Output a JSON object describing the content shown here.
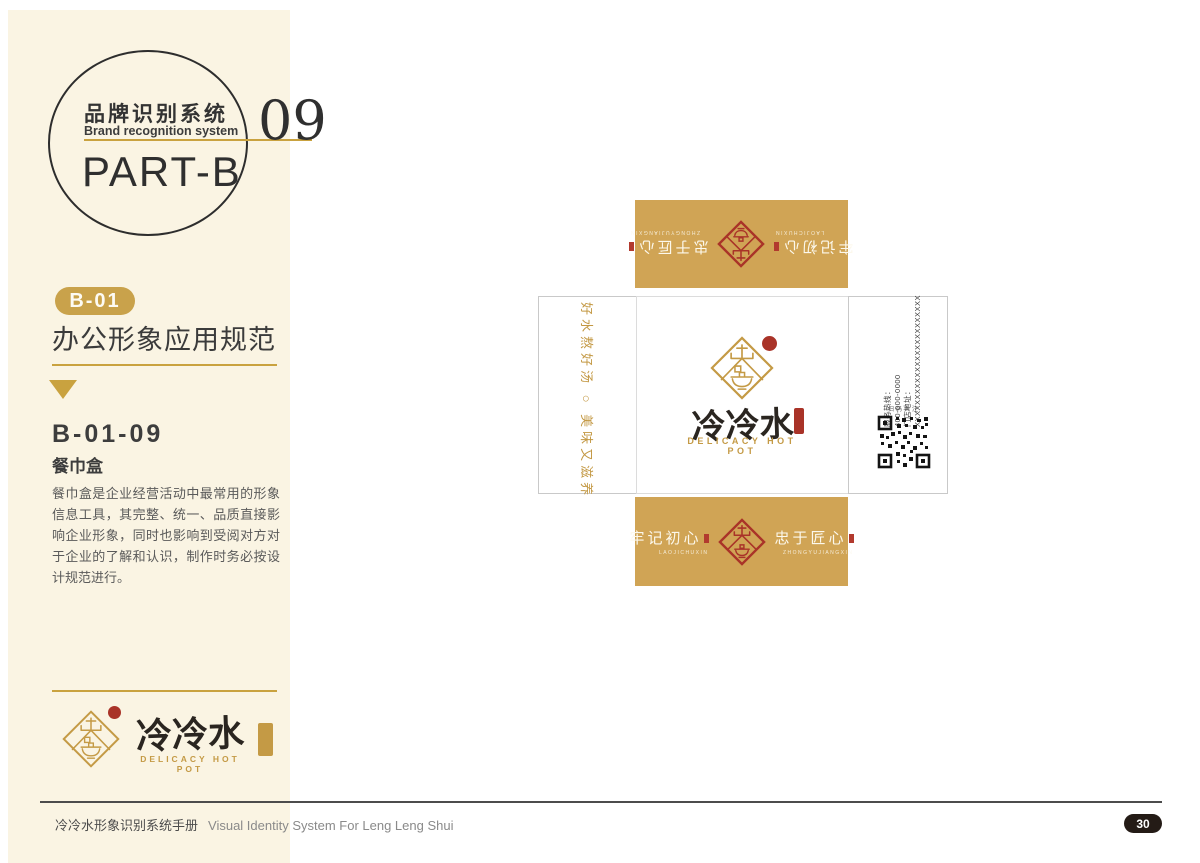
{
  "header": {
    "title_cn": "品牌识别系统",
    "title_en": "Brand recognition system",
    "part": "PART-B",
    "number": "09"
  },
  "sidebar": {
    "badge": "B-01",
    "section_title": "办公形象应用规范",
    "item_code": "B-01-09",
    "item_name": "餐巾盒",
    "description": "餐巾盒是企业经营活动中最常用的形象信息工具，其完整、统一、品质直接影响企业形象，同时也影响到受阅对方对于企业的了解和认识，制作时务必按设计规范进行。",
    "logo": {
      "name_cn": "冷冷水",
      "name_en": "DELICACY HOT POT"
    }
  },
  "dieline": {
    "flap": {
      "left_phrase": "牢记初心",
      "left_pinyin": "LAOJICHUXIN",
      "right_phrase": "忠于匠心",
      "right_pinyin": "ZHONGYUJIANGXIN"
    },
    "panel": {
      "brand_cn": "冷冷水",
      "brand_en": "DELICACY HOT POT"
    },
    "left_panel": {
      "slogan": "好水熬好汤 ○ 美味又滋养"
    },
    "right_panel": {
      "lines": [
        "服务热线：",
        "400-000-0000",
        "门店地址：",
        "XXXXXXXXXXXXXXXXXXXXXXXX"
      ],
      "qr_caption": "扫码关注"
    }
  },
  "footer": {
    "manual_cn": "冷冷水形象识别系统手册",
    "manual_en": "Visual Identity System For Leng Leng Shui",
    "page_number": "30"
  },
  "colors": {
    "gold": "#C49A45",
    "gold_line": "#C9A23F",
    "flap_gold": "#D0A455",
    "seal_red": "#A93328",
    "cream": "#FAF4E3",
    "dark_text": "#3a3a3a",
    "badge_dark": "#241b16"
  }
}
